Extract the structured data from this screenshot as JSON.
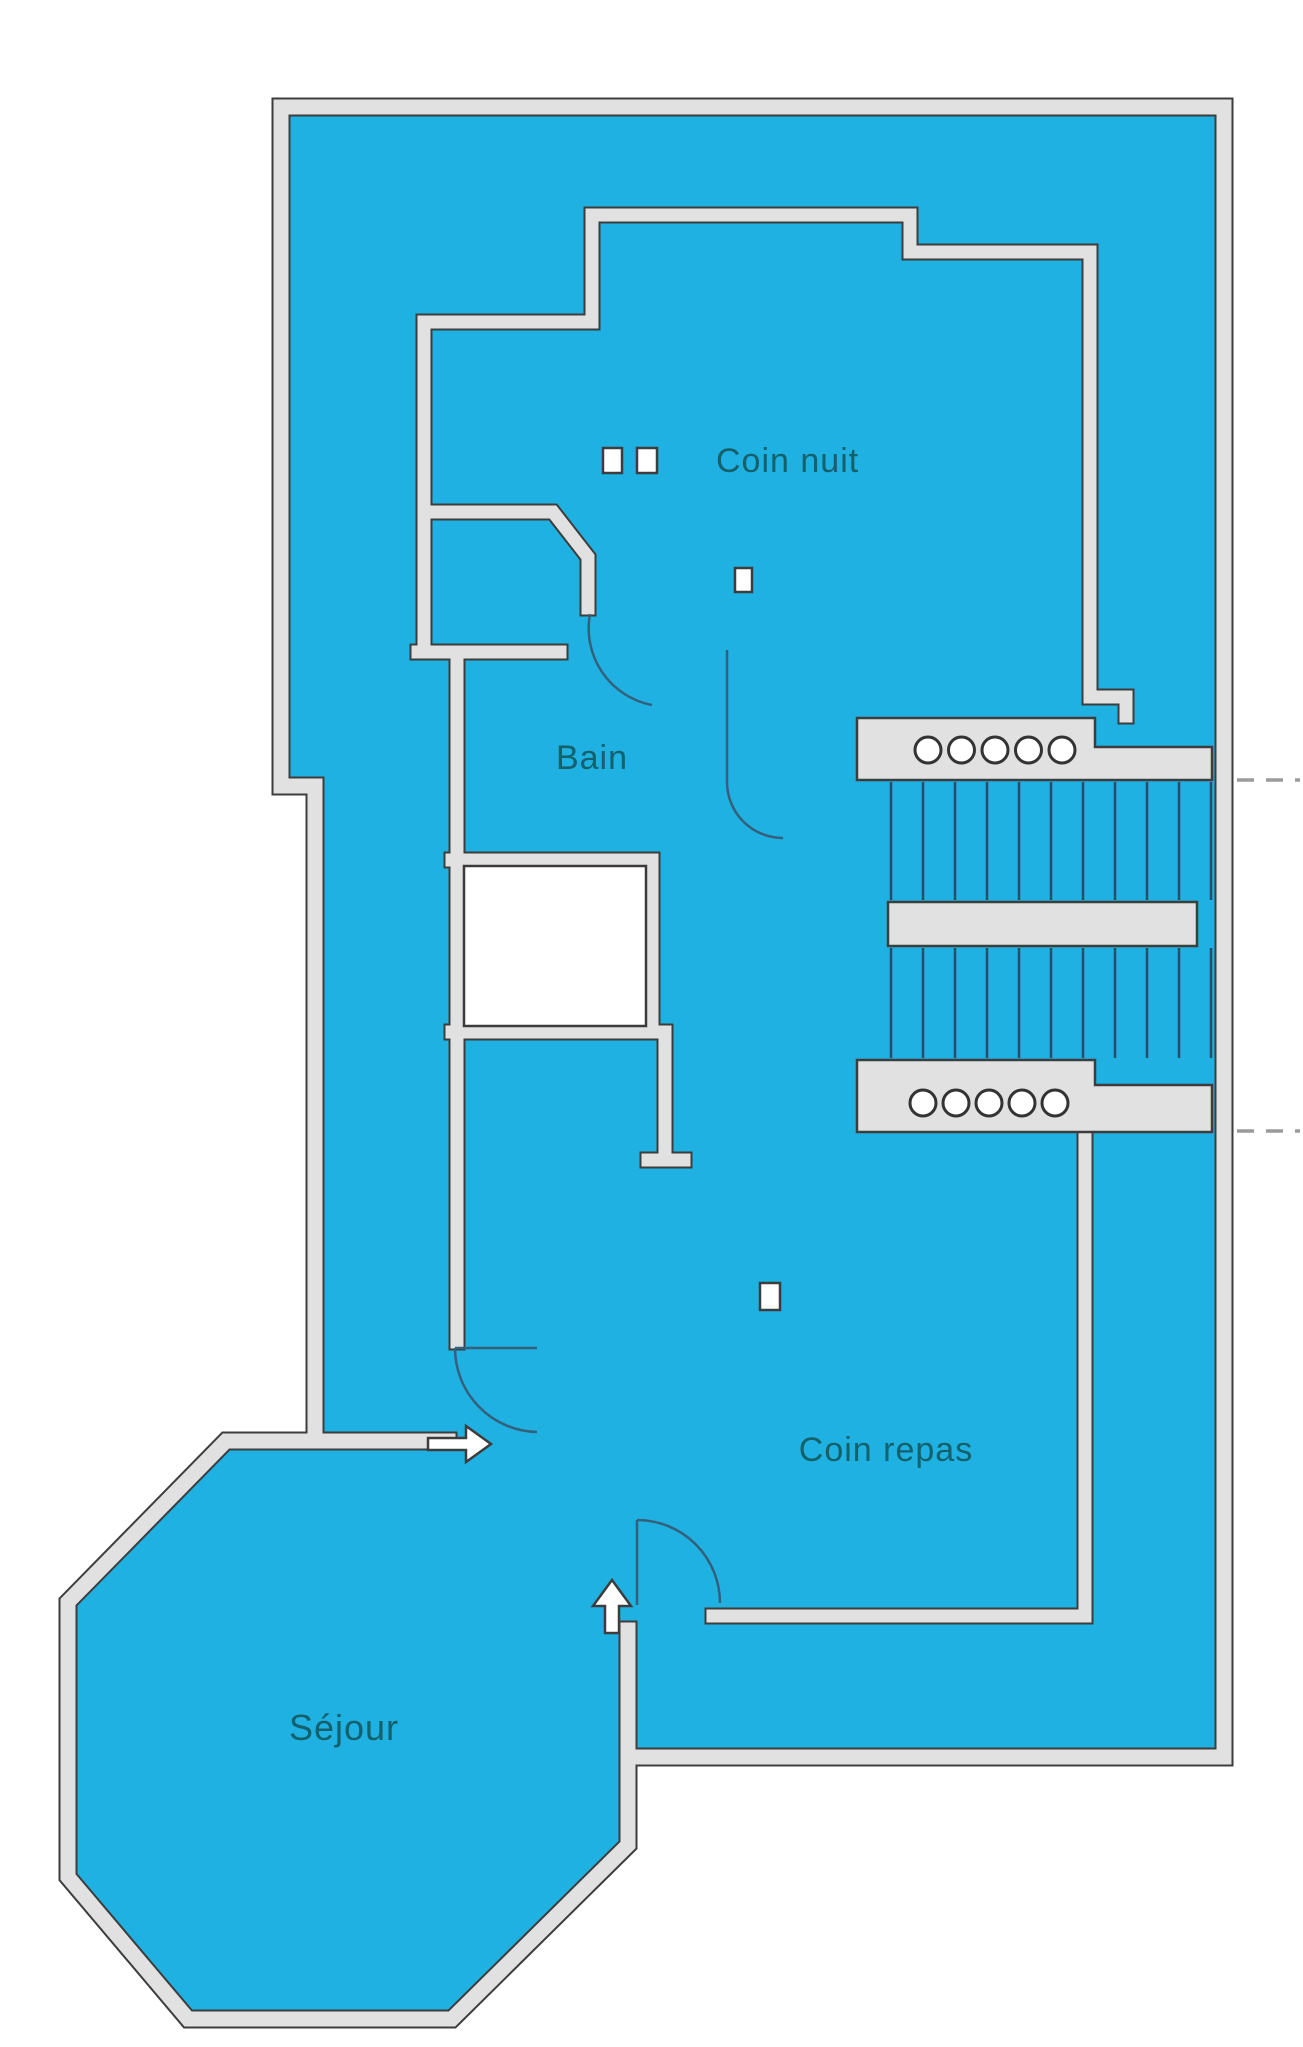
{
  "plan": {
    "title": "apartment-floor-plan",
    "labels": {
      "coin_nuit": "Coin nuit",
      "bain": "Bain",
      "coin_repas": "Coin repas",
      "sejour": "Séjour"
    },
    "colors": {
      "background": "#ffffff",
      "floor": "#1fb1e1",
      "wall_fill": "#e1e1e1",
      "wall_edge": "#3d3d3d",
      "detail_line": "#2b4b66",
      "door_arc": "#35607c",
      "text": "#14606b",
      "dash": "#9b9b9b"
    },
    "stairs": {
      "top_landing_balusters": 5,
      "bottom_landing_balusters": 5,
      "treads_per_flight": 11,
      "top_baluster_row": {
        "start_x": 928,
        "step": 33.5,
        "cy": 750,
        "r": 13
      },
      "bottom_baluster_row": {
        "start_x": 923,
        "step": 33,
        "cy": 1103,
        "r": 13
      },
      "tread_field": {
        "start_x": 891,
        "step": 32,
        "upper_y1": 782,
        "upper_y2": 900,
        "lower_y1": 948,
        "lower_y2": 1058
      }
    },
    "section_dashes": {
      "count": 2,
      "y_positions": [
        780,
        1131
      ]
    }
  }
}
